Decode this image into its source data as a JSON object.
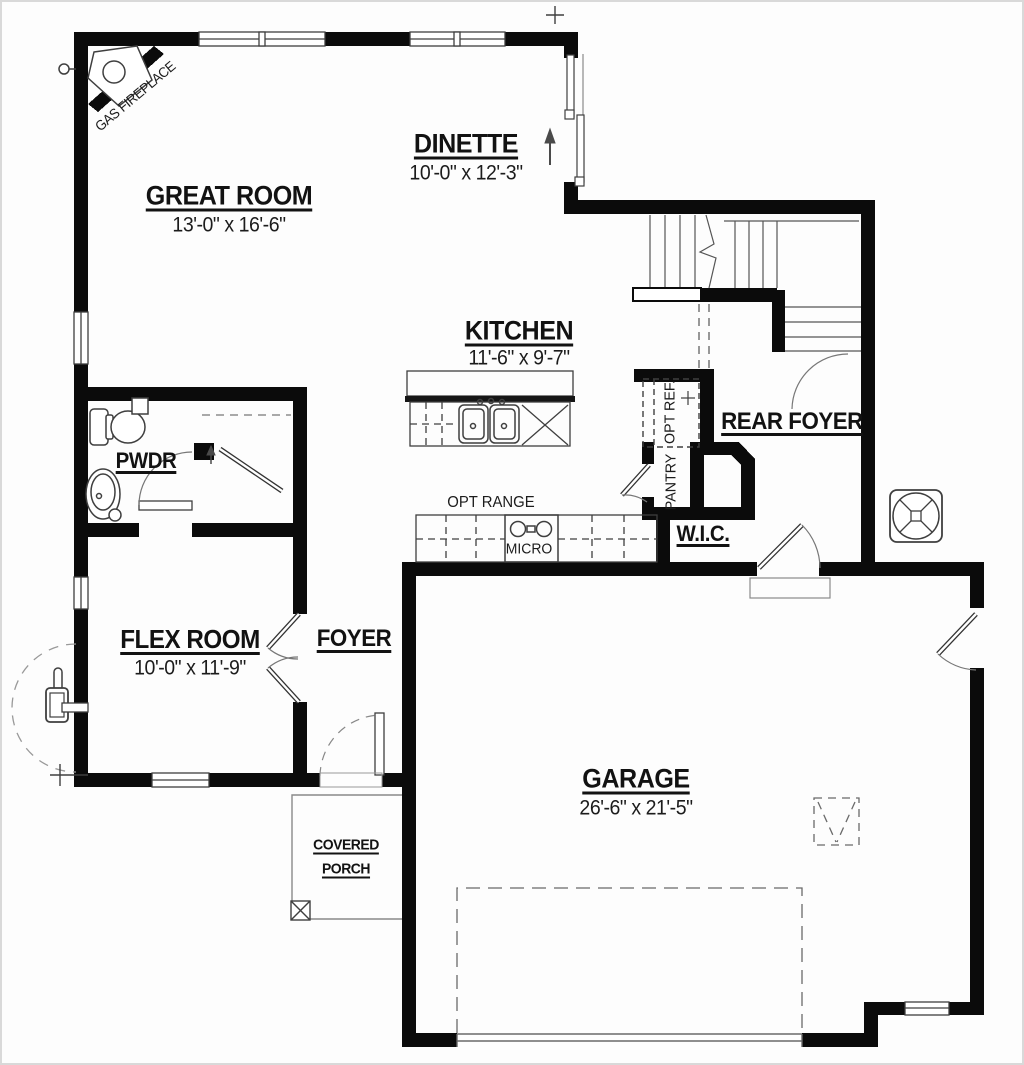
{
  "rooms": {
    "great_room": {
      "name": "GREAT ROOM",
      "dims": "13'-0\" x 16'-6\""
    },
    "dinette": {
      "name": "DINETTE",
      "dims": "10'-0\" x 12'-3\""
    },
    "kitchen": {
      "name": "KITCHEN",
      "dims": "11'-6\" x 9'-7\""
    },
    "flex_room": {
      "name": "FLEX ROOM",
      "dims": "10'-0\" x 11'-9\""
    },
    "garage": {
      "name": "GARAGE",
      "dims": "26'-6\" x 21'-5\""
    },
    "pwdr": {
      "name": "PWDR"
    },
    "foyer": {
      "name": "FOYER"
    },
    "rear_foyer": {
      "name": "REAR FOYER"
    },
    "wic": {
      "name": "W.I.C."
    },
    "covered_porch": {
      "name": "COVERED PORCH",
      "line1": "COVERED",
      "line2": "PORCH"
    }
  },
  "annotations": {
    "gas_fireplace": "GAS FIREPLACE",
    "opt_range": "OPT RANGE",
    "micro": "MICRO",
    "opt_ref": "OPT REF.",
    "pantry": "PANTRY"
  },
  "icons": {
    "fan": "fan-symbol",
    "gas_meter": "gas-meter-symbol",
    "attic_hatch": "attic-access-hatch",
    "porch_post": "porch-post"
  },
  "colors": {
    "wall": "#0b0b0b",
    "thin_line": "#3f3f3f",
    "light_line": "#8a8a8a",
    "text": "#121212",
    "background": "#fdfdfd",
    "border": "#d9d9d9"
  }
}
